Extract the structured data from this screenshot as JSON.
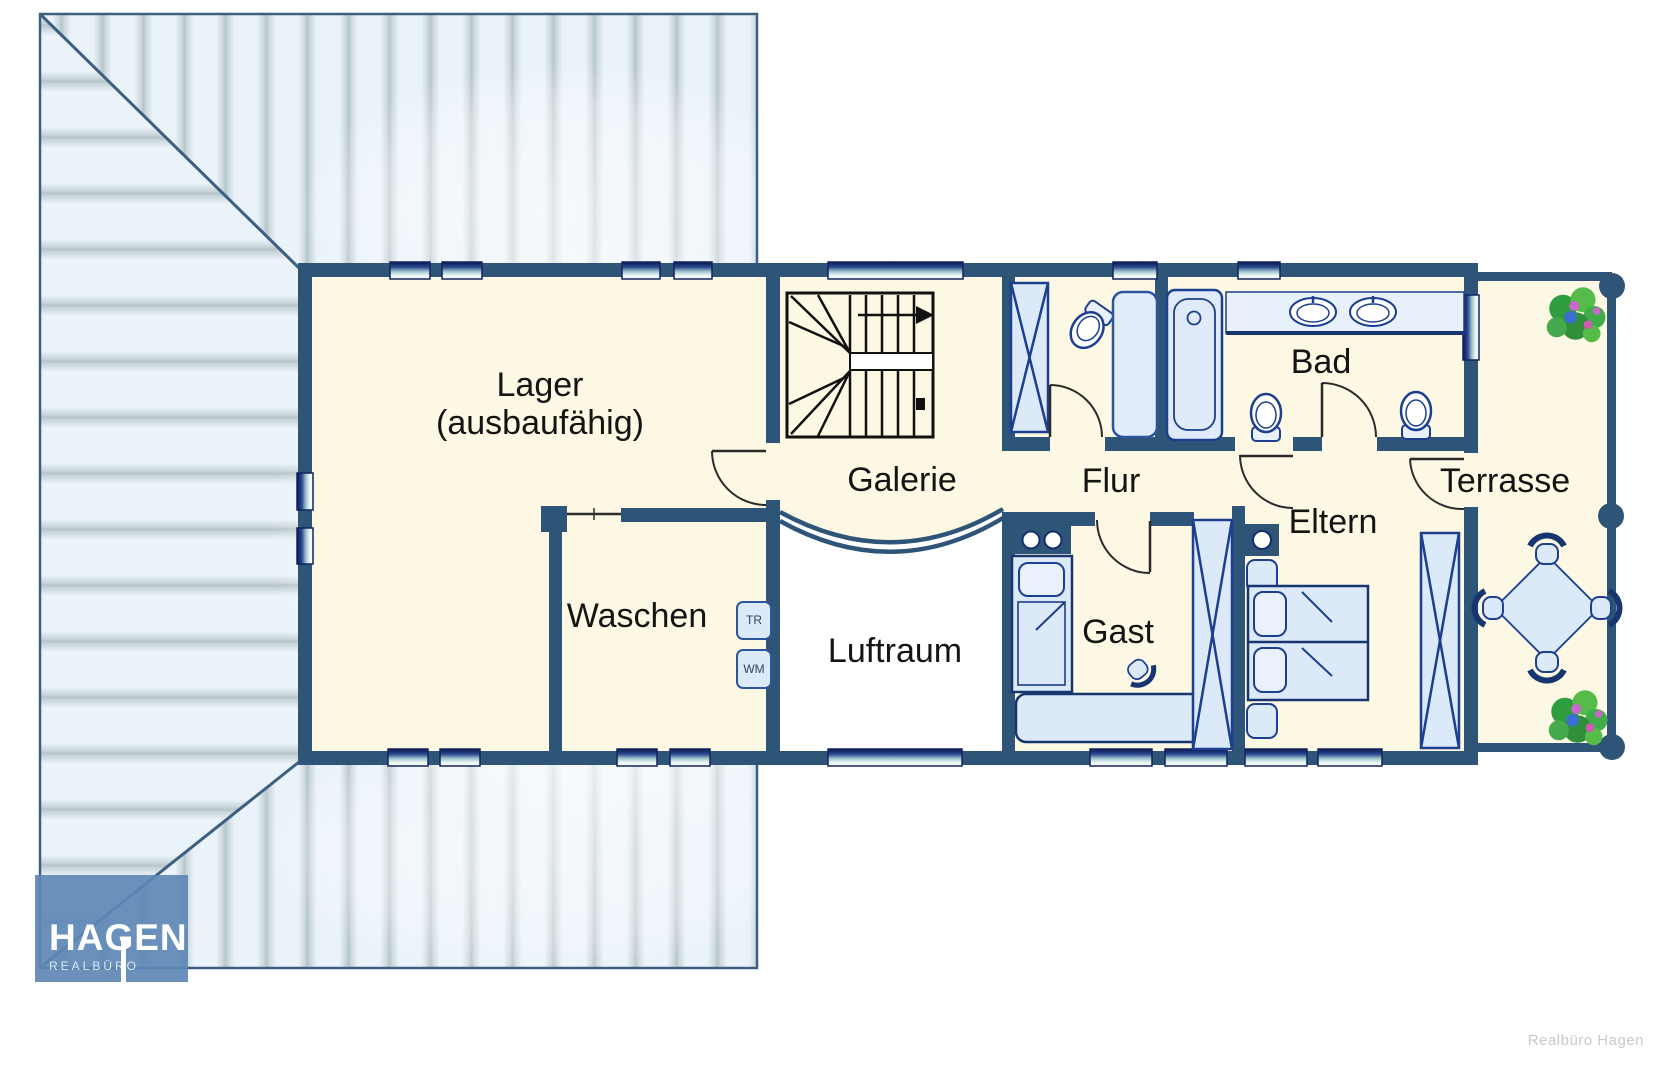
{
  "page": {
    "background": "#ffffff"
  },
  "floor_plan": {
    "labels": {
      "lager_title": "Lager",
      "lager_subtitle": "(ausbaufähig)",
      "waschen": "Waschen",
      "galerie": "Galerie",
      "luftraum": "Luftraum",
      "flur": "Flur",
      "gast": "Gast",
      "bad": "Bad",
      "eltern": "Eltern",
      "terrasse": "Terrasse"
    },
    "appliances": {
      "dryer": "TR",
      "washer": "WM"
    },
    "colors": {
      "wall": "#2e5578",
      "room_fill": "#fdf8e3",
      "void_fill": "#ffffff",
      "furniture_fill": "#dce9f9",
      "furniture_stroke": "#17356e",
      "window_dark": "#0c1650",
      "roof_base": "#e9f1fa",
      "roof_stripe": "#b5c6cb",
      "plant_green": "#3fae4a",
      "logo_background": "#6089b8",
      "credit_text": "#c9c9c9"
    }
  },
  "branding": {
    "logo_title": "HAGEN",
    "logo_subtitle": "REALBÜRO",
    "credit": "Realbüro Hagen"
  }
}
